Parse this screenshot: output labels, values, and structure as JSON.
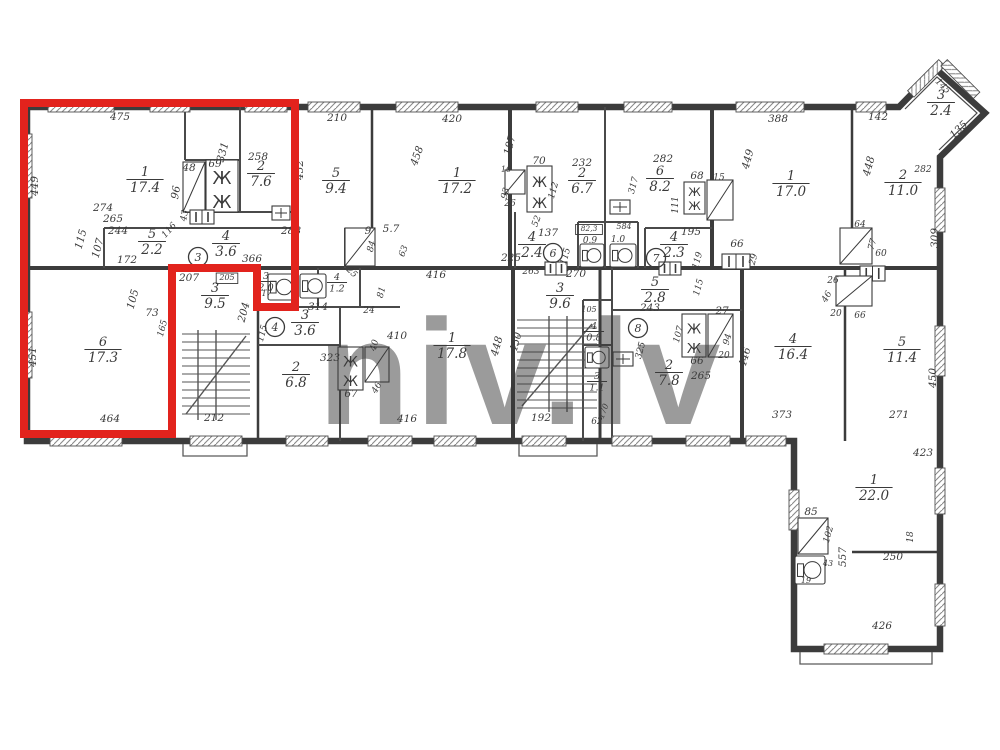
{
  "watermark": "niv.lv",
  "colors": {
    "highlight": "#e2231d",
    "ink": "#3a3a3a",
    "paper": "#ffffff",
    "watermark_gray": "#c3c3c3"
  },
  "highlight": {
    "shape": "polygon",
    "points": "24,103 295,103 295,307 257,307 257,268 172,268 172,434 24,434"
  },
  "rooms": [
    {
      "num": "1",
      "area": "17.4",
      "x": 145,
      "y": 176
    },
    {
      "num": "2",
      "area": "7.6",
      "x": 261,
      "y": 170
    },
    {
      "num": "5",
      "area": "2.2",
      "x": 152,
      "y": 238
    },
    {
      "num": "4",
      "area": "3.6",
      "x": 226,
      "y": 240
    },
    {
      "num": "6",
      "area": "17.3",
      "x": 103,
      "y": 346
    },
    {
      "num": "3",
      "area": "9.5",
      "x": 215,
      "y": 292
    },
    {
      "num": "3",
      "area": "2.0",
      "x": 266,
      "y": 279,
      "s": 1
    },
    {
      "num": "5",
      "area": "9.4",
      "x": 336,
      "y": 177
    },
    {
      "num": "1",
      "area": "17.2",
      "x": 457,
      "y": 177
    },
    {
      "num": "4",
      "area": "1.2",
      "x": 337,
      "y": 280,
      "s": 1
    },
    {
      "num": "3",
      "area": "3.6",
      "x": 305,
      "y": 319
    },
    {
      "num": "2",
      "area": "6.8",
      "x": 296,
      "y": 371
    },
    {
      "num": "1",
      "area": "17.8",
      "x": 452,
      "y": 342
    },
    {
      "num": "2",
      "area": "6.7",
      "x": 582,
      "y": 177
    },
    {
      "num": "6",
      "area": "8.2",
      "x": 660,
      "y": 175
    },
    {
      "num": "4",
      "area": "2.4",
      "x": 532,
      "y": 241
    },
    {
      "num": "4",
      "area": "2.3",
      "x": 674,
      "y": 241
    },
    {
      "num": "3",
      "area": "9.6",
      "x": 560,
      "y": 292
    },
    {
      "num": "4",
      "area": "0.8",
      "x": 594,
      "y": 329,
      "s": 1
    },
    {
      "num": "3",
      "area": "1.1",
      "x": 597,
      "y": 379,
      "s": 1
    },
    {
      "num": "5",
      "area": "2.8",
      "x": 655,
      "y": 286
    },
    {
      "num": "2",
      "area": "7.8",
      "x": 669,
      "y": 369
    },
    {
      "num": "1",
      "area": "17.0",
      "x": 791,
      "y": 180
    },
    {
      "num": "2",
      "area": "11.0",
      "x": 903,
      "y": 179
    },
    {
      "num": "3",
      "area": "2.4",
      "x": 941,
      "y": 99
    },
    {
      "num": "4",
      "area": "16.4",
      "x": 793,
      "y": 343
    },
    {
      "num": "5",
      "area": "11.4",
      "x": 902,
      "y": 346
    },
    {
      "num": "1",
      "area": "22.0",
      "x": 874,
      "y": 484
    }
  ],
  "entrances": [
    {
      "n": "3",
      "x": 198,
      "y": 257
    },
    {
      "n": "4",
      "x": 275,
      "y": 327
    },
    {
      "n": "6",
      "x": 553,
      "y": 253
    },
    {
      "n": "7",
      "x": 656,
      "y": 258
    },
    {
      "n": "8",
      "x": 638,
      "y": 328
    }
  ],
  "dims": [
    {
      "t": "475",
      "x": 120,
      "y": 120
    },
    {
      "t": "210",
      "x": 337,
      "y": 121
    },
    {
      "t": "420",
      "x": 452,
      "y": 122
    },
    {
      "t": "388",
      "x": 778,
      "y": 122
    },
    {
      "t": "142",
      "x": 878,
      "y": 120
    },
    {
      "t": "145",
      "x": 941,
      "y": 88,
      "r": 45,
      "s": 9
    },
    {
      "t": "135",
      "x": 961,
      "y": 132,
      "r": -45
    },
    {
      "t": "449",
      "x": 38,
      "y": 186,
      "r": -90
    },
    {
      "t": "451",
      "x": 36,
      "y": 357,
      "r": -90
    },
    {
      "t": "274",
      "x": 103,
      "y": 211
    },
    {
      "t": "265",
      "x": 113,
      "y": 222
    },
    {
      "t": "244",
      "x": 118,
      "y": 234
    },
    {
      "t": "115",
      "x": 84,
      "y": 240,
      "r": -75
    },
    {
      "t": "107",
      "x": 101,
      "y": 249,
      "r": -75
    },
    {
      "t": "172",
      "x": 127,
      "y": 263
    },
    {
      "t": "116",
      "x": 171,
      "y": 232,
      "r": -48,
      "s": 9
    },
    {
      "t": "48",
      "x": 189,
      "y": 171
    },
    {
      "t": "69",
      "x": 215,
      "y": 167
    },
    {
      "t": "331",
      "x": 226,
      "y": 153,
      "r": -75
    },
    {
      "t": "96",
      "x": 179,
      "y": 193,
      "r": -80
    },
    {
      "t": "43",
      "x": 187,
      "y": 216,
      "r": -80,
      "s": 9
    },
    {
      "t": "258",
      "x": 258,
      "y": 160
    },
    {
      "t": "288",
      "x": 291,
      "y": 234
    },
    {
      "t": "366",
      "x": 252,
      "y": 262
    },
    {
      "t": "452",
      "x": 303,
      "y": 170,
      "r": -90
    },
    {
      "t": "207",
      "x": 189,
      "y": 281
    },
    {
      "t": "205",
      "x": 227,
      "y": 280,
      "s": 8,
      "b": 1
    },
    {
      "t": "117",
      "x": 264,
      "y": 296,
      "s": 8
    },
    {
      "t": "105",
      "x": 136,
      "y": 300,
      "r": -75
    },
    {
      "t": "73",
      "x": 152,
      "y": 316
    },
    {
      "t": "165",
      "x": 165,
      "y": 329,
      "r": -75,
      "s": 9
    },
    {
      "t": "204",
      "x": 247,
      "y": 313,
      "r": -75
    },
    {
      "t": "115",
      "x": 265,
      "y": 334,
      "r": -75,
      "s": 9
    },
    {
      "t": "464",
      "x": 110,
      "y": 422
    },
    {
      "t": "212",
      "x": 214,
      "y": 421
    },
    {
      "t": "9",
      "x": 368,
      "y": 234
    },
    {
      "t": "5.7",
      "x": 391,
      "y": 232
    },
    {
      "t": "84",
      "x": 374,
      "y": 247,
      "r": -75,
      "s": 9
    },
    {
      "t": "63",
      "x": 406,
      "y": 252,
      "r": -70,
      "s": 9
    },
    {
      "t": "458",
      "x": 420,
      "y": 157,
      "r": -70
    },
    {
      "t": "25",
      "x": 350,
      "y": 274,
      "r": 45,
      "s": 9
    },
    {
      "t": "314",
      "x": 318,
      "y": 310
    },
    {
      "t": "81",
      "x": 384,
      "y": 293,
      "r": -75,
      "s": 9
    },
    {
      "t": "24",
      "x": 369,
      "y": 313,
      "s": 9
    },
    {
      "t": "40",
      "x": 377,
      "y": 346,
      "r": -75,
      "s": 9
    },
    {
      "t": "46",
      "x": 379,
      "y": 389,
      "r": -60,
      "s": 9
    },
    {
      "t": "67",
      "x": 351,
      "y": 397
    },
    {
      "t": "323",
      "x": 330,
      "y": 361
    },
    {
      "t": "410",
      "x": 397,
      "y": 339
    },
    {
      "t": "416",
      "x": 436,
      "y": 278
    },
    {
      "t": "416",
      "x": 407,
      "y": 422
    },
    {
      "t": "448",
      "x": 500,
      "y": 347,
      "r": -75
    },
    {
      "t": "450",
      "x": 519,
      "y": 343,
      "r": -75
    },
    {
      "t": "192",
      "x": 541,
      "y": 421
    },
    {
      "t": "62",
      "x": 597,
      "y": 424,
      "s": 9
    },
    {
      "t": "170",
      "x": 606,
      "y": 412,
      "r": -70,
      "s": 8
    },
    {
      "t": "187",
      "x": 513,
      "y": 146,
      "r": -75
    },
    {
      "t": "16",
      "x": 506,
      "y": 172,
      "s": 8
    },
    {
      "t": "93",
      "x": 508,
      "y": 194,
      "r": -75,
      "s": 9
    },
    {
      "t": "26",
      "x": 510,
      "y": 206,
      "s": 9
    },
    {
      "t": "52",
      "x": 539,
      "y": 222,
      "r": -70,
      "s": 9
    },
    {
      "t": "137",
      "x": 548,
      "y": 236
    },
    {
      "t": "225",
      "x": 511,
      "y": 261
    },
    {
      "t": "232",
      "x": 582,
      "y": 166
    },
    {
      "t": "70",
      "x": 539,
      "y": 164
    },
    {
      "t": "112",
      "x": 556,
      "y": 191,
      "r": -75,
      "s": 9
    },
    {
      "t": "282",
      "x": 663,
      "y": 162
    },
    {
      "t": "317",
      "x": 636,
      "y": 186,
      "r": -75,
      "s": 9
    },
    {
      "t": "68",
      "x": 697,
      "y": 179
    },
    {
      "t": "15",
      "x": 719,
      "y": 180,
      "s": 9
    },
    {
      "t": "111",
      "x": 678,
      "y": 205,
      "r": -90,
      "s": 9
    },
    {
      "t": "195",
      "x": 691,
      "y": 235
    },
    {
      "t": "66",
      "x": 737,
      "y": 247
    },
    {
      "t": "29",
      "x": 756,
      "y": 260,
      "r": -75,
      "s": 9
    },
    {
      "t": "263",
      "x": 531,
      "y": 274,
      "s": 9
    },
    {
      "t": "270",
      "x": 576,
      "y": 277
    },
    {
      "t": "115",
      "x": 568,
      "y": 257,
      "r": -75,
      "s": 9
    },
    {
      "t": "82,3",
      "x": 589,
      "y": 231,
      "s": 7.5,
      "b": 1
    },
    {
      "t": "0.9",
      "x": 590,
      "y": 243,
      "s": 9
    },
    {
      "t": "584",
      "x": 624,
      "y": 229,
      "s": 8
    },
    {
      "t": "1.0",
      "x": 618,
      "y": 242,
      "s": 9
    },
    {
      "t": "119",
      "x": 700,
      "y": 261,
      "r": -75,
      "s": 9
    },
    {
      "t": "243",
      "x": 650,
      "y": 311
    },
    {
      "t": "115",
      "x": 701,
      "y": 288,
      "r": -75,
      "s": 9
    },
    {
      "t": "107",
      "x": 681,
      "y": 335,
      "r": -75,
      "s": 9
    },
    {
      "t": "66",
      "x": 697,
      "y": 364
    },
    {
      "t": "265",
      "x": 701,
      "y": 379
    },
    {
      "t": "325",
      "x": 643,
      "y": 351,
      "r": -75,
      "s": 9
    },
    {
      "t": "27",
      "x": 722,
      "y": 314
    },
    {
      "t": "94",
      "x": 730,
      "y": 340,
      "r": -75,
      "s": 9
    },
    {
      "t": "20",
      "x": 724,
      "y": 358,
      "s": 9
    },
    {
      "t": "446",
      "x": 748,
      "y": 358,
      "r": -75
    },
    {
      "t": "105",
      "x": 589,
      "y": 312,
      "s": 8
    },
    {
      "t": "449",
      "x": 751,
      "y": 160,
      "r": -75
    },
    {
      "t": "448",
      "x": 872,
      "y": 167,
      "r": -75
    },
    {
      "t": "282",
      "x": 923,
      "y": 172,
      "s": 9
    },
    {
      "t": "309",
      "x": 938,
      "y": 238,
      "r": -90
    },
    {
      "t": "64",
      "x": 860,
      "y": 227,
      "s": 9
    },
    {
      "t": "77",
      "x": 875,
      "y": 245,
      "r": -75,
      "s": 9
    },
    {
      "t": "60",
      "x": 881,
      "y": 256,
      "s": 9
    },
    {
      "t": "26",
      "x": 833,
      "y": 283,
      "s": 9
    },
    {
      "t": "46",
      "x": 829,
      "y": 298,
      "r": -60,
      "s": 9
    },
    {
      "t": "20",
      "x": 836,
      "y": 316,
      "s": 9
    },
    {
      "t": "66",
      "x": 860,
      "y": 318,
      "s": 9
    },
    {
      "t": "373",
      "x": 782,
      "y": 418
    },
    {
      "t": "271",
      "x": 899,
      "y": 418
    },
    {
      "t": "450",
      "x": 936,
      "y": 378,
      "r": -90
    },
    {
      "t": "423",
      "x": 923,
      "y": 456
    },
    {
      "t": "426",
      "x": 882,
      "y": 629
    },
    {
      "t": "85",
      "x": 811,
      "y": 515
    },
    {
      "t": "102",
      "x": 831,
      "y": 535,
      "r": -75,
      "s": 9
    },
    {
      "t": "557",
      "x": 846,
      "y": 557,
      "r": -90
    },
    {
      "t": "250",
      "x": 893,
      "y": 560
    },
    {
      "t": "18",
      "x": 913,
      "y": 537,
      "r": -90,
      "s": 9
    },
    {
      "t": "43",
      "x": 828,
      "y": 566,
      "s": 8
    },
    {
      "t": "19",
      "x": 806,
      "y": 583,
      "s": 8
    }
  ],
  "fixtures": [
    {
      "type": "closet-diag",
      "x": 183,
      "y": 162,
      "w": 22,
      "h": 50
    },
    {
      "type": "wardrobe",
      "x": 206,
      "y": 160,
      "w": 32,
      "h": 52
    },
    {
      "type": "door2",
      "x": 190,
      "y": 210,
      "w": 24,
      "h": 14
    },
    {
      "type": "vent",
      "x": 272,
      "y": 206,
      "w": 18,
      "h": 14
    },
    {
      "type": "wc",
      "x": 268,
      "y": 274,
      "w": 28,
      "h": 26
    },
    {
      "type": "wc",
      "x": 300,
      "y": 274,
      "w": 26,
      "h": 24
    },
    {
      "type": "closet-diag",
      "x": 345,
      "y": 228,
      "w": 30,
      "h": 38
    },
    {
      "type": "closet-diag",
      "x": 505,
      "y": 170,
      "w": 20,
      "h": 24
    },
    {
      "type": "wardrobe",
      "x": 527,
      "y": 166,
      "w": 25,
      "h": 46
    },
    {
      "type": "vent",
      "x": 610,
      "y": 200,
      "w": 20,
      "h": 14
    },
    {
      "type": "wardrobe",
      "x": 684,
      "y": 182,
      "w": 21,
      "h": 32
    },
    {
      "type": "closet-diag",
      "x": 707,
      "y": 180,
      "w": 26,
      "h": 40
    },
    {
      "type": "door2",
      "x": 545,
      "y": 262,
      "w": 22,
      "h": 13
    },
    {
      "type": "door2",
      "x": 659,
      "y": 262,
      "w": 22,
      "h": 13
    },
    {
      "type": "door2",
      "x": 722,
      "y": 254,
      "w": 28,
      "h": 15
    },
    {
      "type": "wc",
      "x": 580,
      "y": 244,
      "w": 24,
      "h": 23
    },
    {
      "type": "wc",
      "x": 610,
      "y": 244,
      "w": 26,
      "h": 23
    },
    {
      "type": "wc",
      "x": 585,
      "y": 347,
      "w": 24,
      "h": 21
    },
    {
      "type": "vent",
      "x": 613,
      "y": 352,
      "w": 20,
      "h": 14
    },
    {
      "type": "wardrobe",
      "x": 682,
      "y": 314,
      "w": 24,
      "h": 43
    },
    {
      "type": "closet-diag",
      "x": 708,
      "y": 314,
      "w": 25,
      "h": 43
    },
    {
      "type": "wardrobe",
      "x": 338,
      "y": 347,
      "w": 25,
      "h": 43
    },
    {
      "type": "closet-diag",
      "x": 365,
      "y": 347,
      "w": 24,
      "h": 35
    },
    {
      "type": "closet-diag",
      "x": 840,
      "y": 228,
      "w": 32,
      "h": 36
    },
    {
      "type": "door2",
      "x": 860,
      "y": 266,
      "w": 25,
      "h": 15
    },
    {
      "type": "closet-diag",
      "x": 836,
      "y": 276,
      "w": 36,
      "h": 30
    },
    {
      "type": "closet-diag",
      "x": 798,
      "y": 518,
      "w": 30,
      "h": 36
    },
    {
      "type": "wc",
      "x": 795,
      "y": 556,
      "w": 30,
      "h": 28
    }
  ]
}
